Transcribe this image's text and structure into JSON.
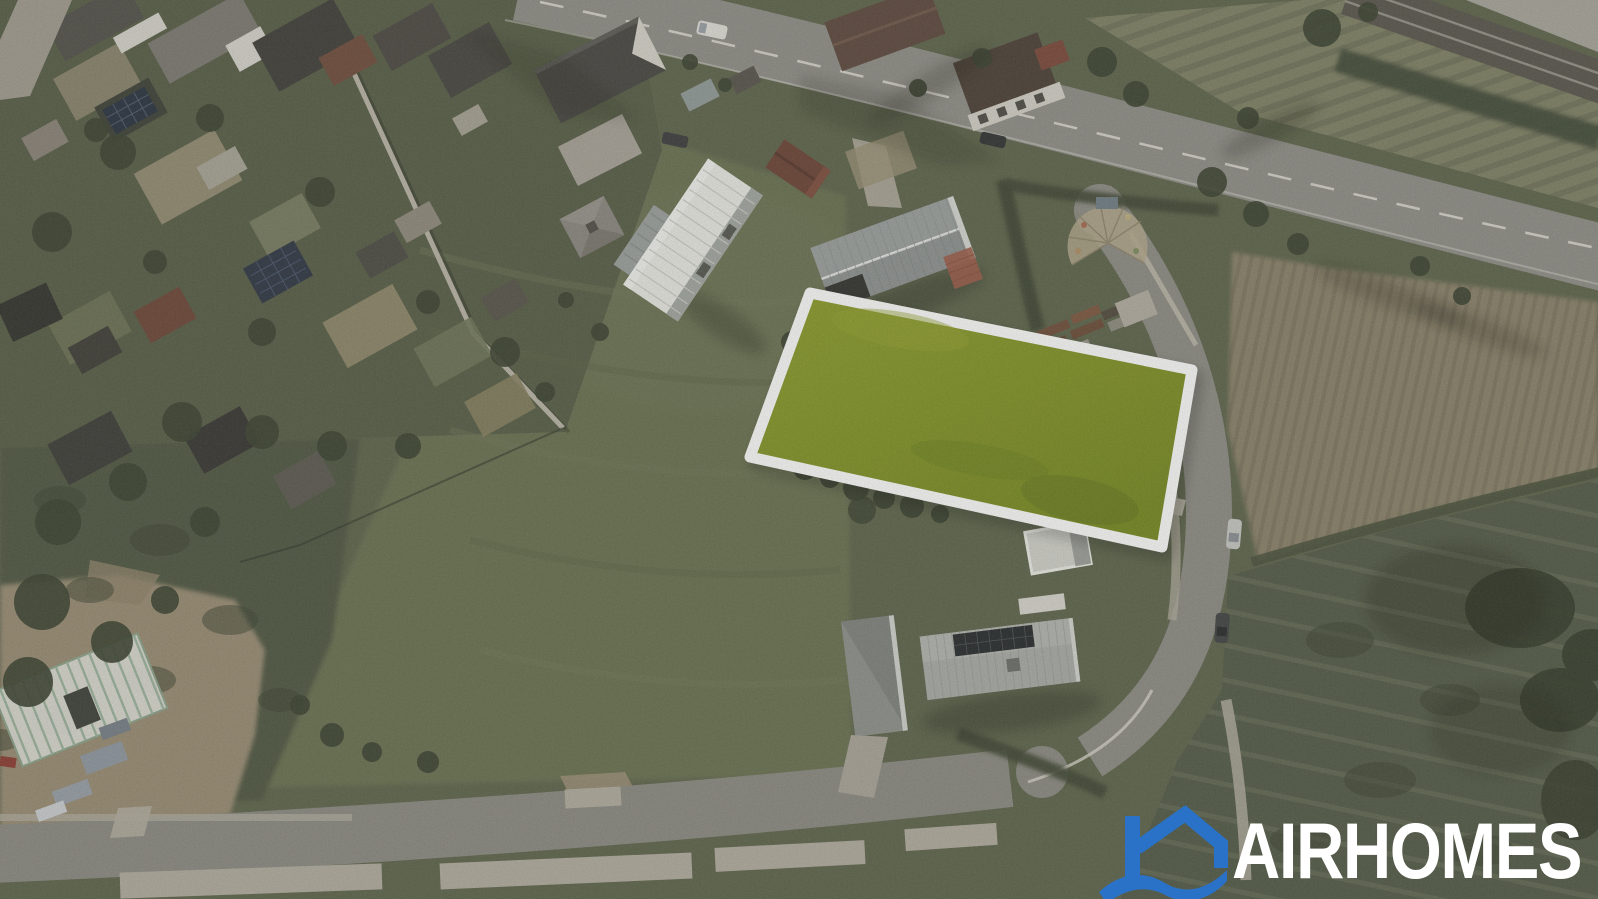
{
  "image": {
    "kind": "aerial drone photograph",
    "description": "Bird's-eye view of a village edge: allotment gardens and houses top-left, a main road across the top, a railway line in the top-right corner, farm fields on the right, new houses with metal roofs, a street along the bottom, and a vacant building plot highlighted in yellow-green with a white outline in the centre."
  },
  "watermark": {
    "brand": "AIRHOMES",
    "text_color": "#ffffff",
    "icon": "house-wave-icon",
    "icon_color": "#2a72c8"
  },
  "highlighted_parcel": {
    "label": "building plot for sale",
    "fill": "#75881d",
    "fill_light": "#8c9d28",
    "outline": "#ffffff"
  },
  "scene": {
    "roads": [
      "main road (top)",
      "side road (right)",
      "street (bottom)"
    ],
    "railway": "railway line (top-right corner)",
    "features": [
      "allotment gardens with sheds (top left)",
      "white tiny house",
      "grey standing-seam roof house",
      "house with rooftop solar panels (bottom)",
      "steel roof framing under construction (bottom left)",
      "hay and pasture fields (right)"
    ],
    "vehicles": [
      "white van on main road",
      "dark car on main road",
      "dark car near junction",
      "silver car on side road",
      "dark car on side road"
    ]
  },
  "palette": {
    "lawn": "#677050",
    "rough_field": "#4d5440",
    "allotment_base": "#555c45",
    "hay_field": "#8a8169",
    "road": "#8f8e88",
    "sidewalk": "#b2ada0",
    "tree": "#39412f",
    "white_roof": "#ececе8",
    "metal_roof": "#9ba09f",
    "dirt": "#998c73"
  }
}
